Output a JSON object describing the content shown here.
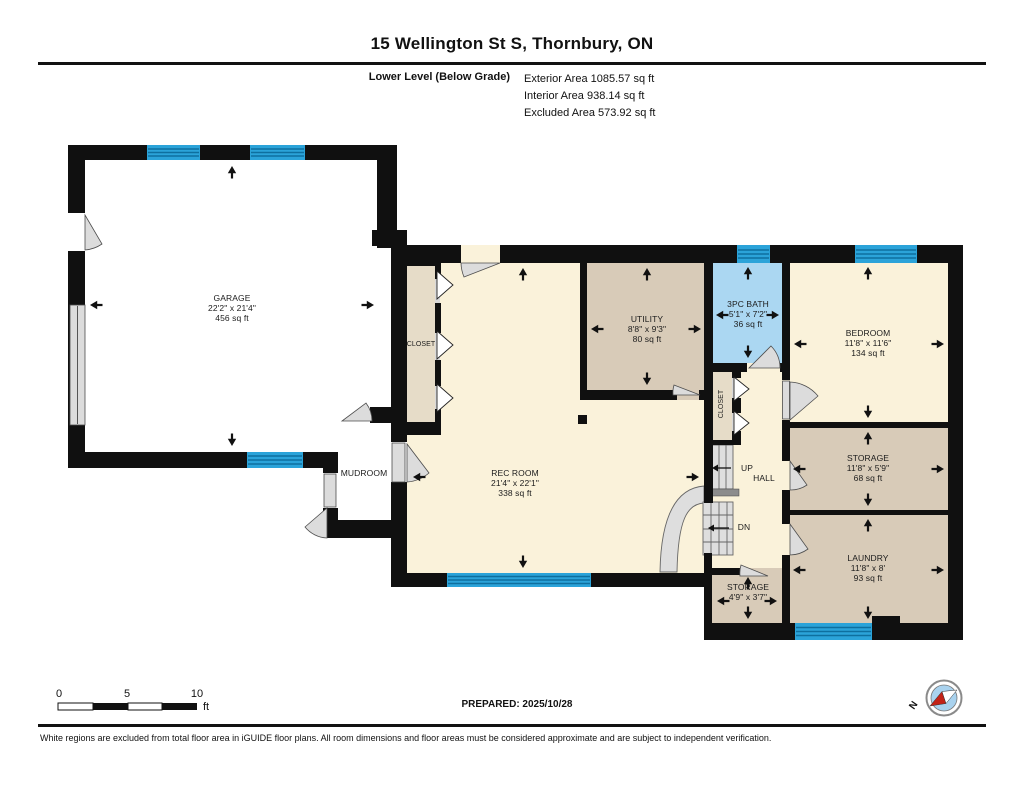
{
  "header": {
    "title": "15 Wellington St S, Thornbury, ON",
    "level_label": "Lower Level (Below Grade)",
    "area_lines": [
      "Exterior Area 1085.57 sq ft",
      "Interior Area 938.14 sq ft",
      "Excluded Area 573.92 sq ft"
    ]
  },
  "rooms": {
    "garage": {
      "name": "GARAGE",
      "dims": "22'2\" x 21'4\"",
      "area": "456 sq ft"
    },
    "mudroom": {
      "name": "MUDROOM"
    },
    "rec_closet": {
      "name": "CLOSET"
    },
    "rec_room": {
      "name": "REC ROOM",
      "dims": "21'4\" x 22'1\"",
      "area": "338 sq ft"
    },
    "utility": {
      "name": "UTILITY",
      "dims": "8'8\" x 9'3\"",
      "area": "80 sq ft"
    },
    "bath": {
      "name": "3PC BATH",
      "dims": "5'1\" x 7'2\"",
      "area": "36 sq ft"
    },
    "bedroom": {
      "name": "BEDROOM",
      "dims": "11'8\" x 11'6\"",
      "area": "134 sq ft"
    },
    "hall_closet": {
      "name": "CLOSET"
    },
    "hall": {
      "name": "HALL",
      "up": "UP",
      "dn": "DN"
    },
    "storage": {
      "name": "STORAGE",
      "dims": "11'8\" x 5'9\"",
      "area": "68 sq ft"
    },
    "laundry": {
      "name": "LAUNDRY",
      "dims": "11'8\" x 8'",
      "area": "93 sq ft"
    },
    "storage_small": {
      "name": "STORAGE",
      "dims": "4'9\" x 3'7\""
    }
  },
  "footer": {
    "prepared": "PREPARED: 2025/10/28",
    "scale": {
      "start": "0",
      "mid": "5",
      "end": "10",
      "unit": "ft"
    },
    "compass_north": "N",
    "disclaimer": "White regions are excluded from total floor area in iGUIDE floor plans. All room dimensions and floor areas must be considered approximate and are subject to independent verification."
  },
  "colors": {
    "wall": "#101010",
    "cream": "#FAF2DA",
    "tan": "#D8CBB8",
    "beige": "#E6DCC8",
    "bathblue": "#ABD7F2",
    "winblue": "#2BA3D9",
    "winline": "#0E6F9F",
    "door": "#DCDCDC",
    "doorline": "#4D4D4D",
    "stair": "#DEDEDE",
    "stairdark": "#8C8C8C",
    "compassblue": "#A9D2EE",
    "compassred": "#C22217"
  }
}
